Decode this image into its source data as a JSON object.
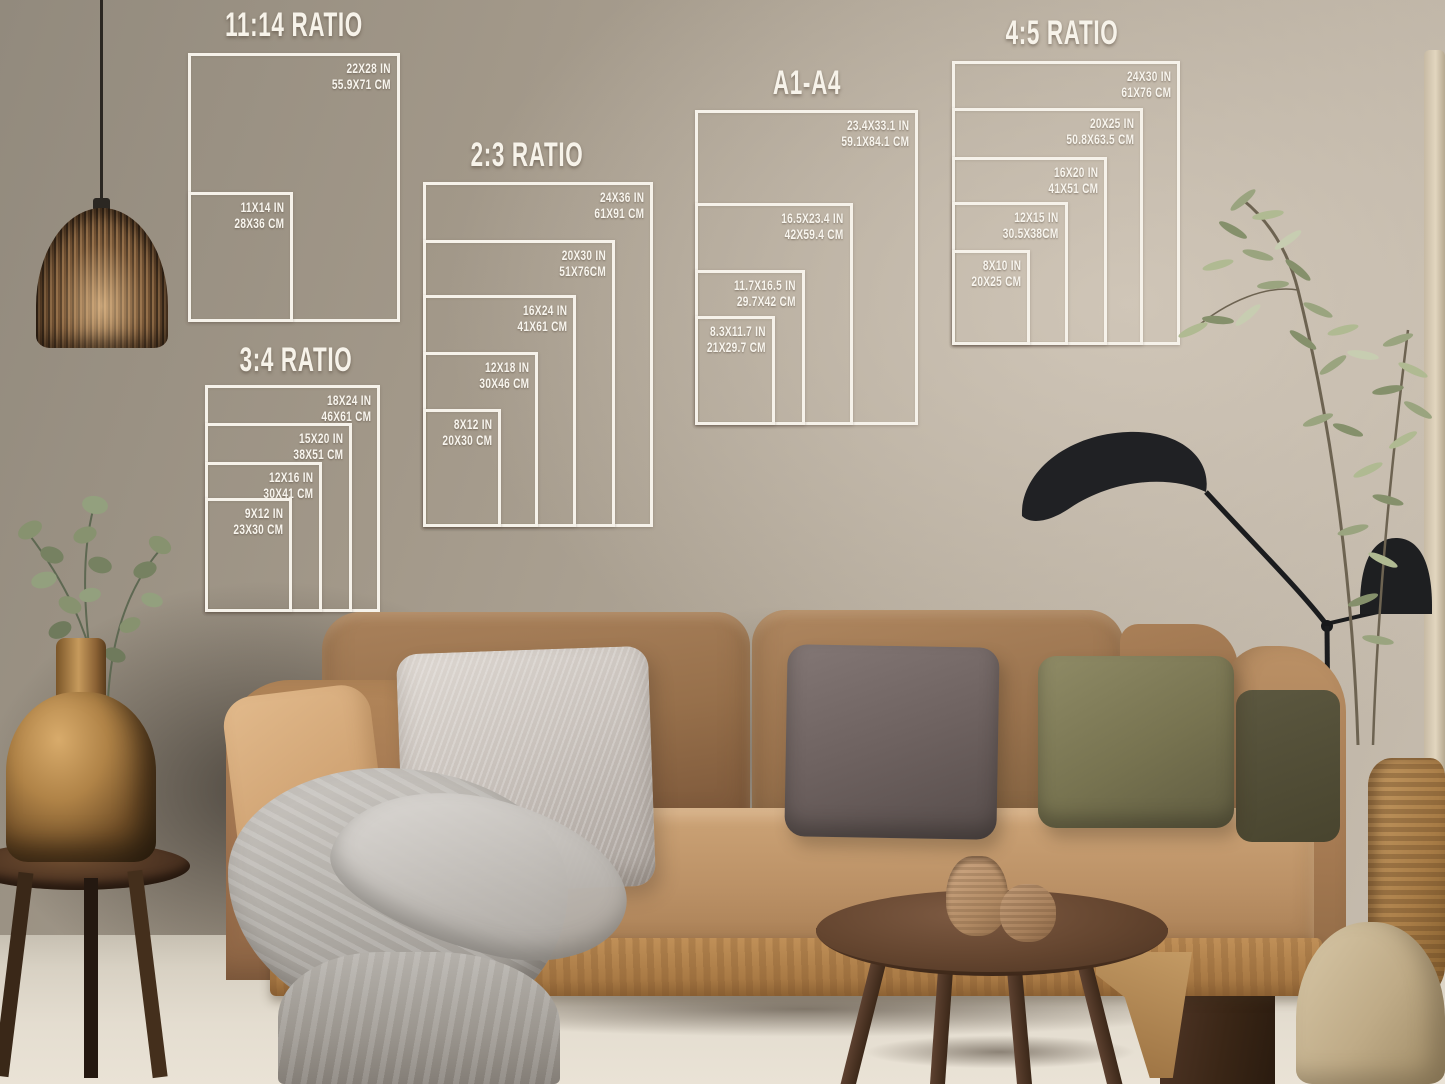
{
  "page": {
    "type": "print-size-guide-mockup",
    "setting": "living-room wall above a tan sofa"
  },
  "palette": {
    "overlay_white": "#f6f2ea",
    "wall": "#aca090",
    "sofa_tan": "#a87c52",
    "floor": "#ddd6c8",
    "lamp_black": "#1e1f21",
    "vase_bronze": "#a97c42",
    "pillow_silver": "#c9c2bc",
    "pillow_dark_gray": "#6e6260",
    "pillow_olive": "#777350"
  },
  "size_guides": [
    {
      "title": "11:14 RATIO",
      "title_cx": 294,
      "title_top": 6,
      "frames": [
        {
          "size_in": "22X28 IN",
          "size_cm": "55.9X71 CM",
          "rect": [
            188,
            53,
            212,
            269
          ]
        },
        {
          "size_in": "11X14 IN",
          "size_cm": "28X36 CM",
          "rect": [
            188,
            192,
            105,
            130
          ]
        }
      ]
    },
    {
      "title": "2:3 RATIO",
      "title_cx": 527,
      "title_top": 136,
      "frames": [
        {
          "size_in": "24X36 IN",
          "size_cm": "61X91 CM",
          "rect": [
            423,
            182,
            230,
            345
          ]
        },
        {
          "size_in": "20X30 IN",
          "size_cm": "51X76CM",
          "rect": [
            423,
            240,
            192,
            287
          ]
        },
        {
          "size_in": "16X24 IN",
          "size_cm": "41X61 CM",
          "rect": [
            423,
            295,
            153,
            232
          ]
        },
        {
          "size_in": "12X18 IN",
          "size_cm": "30X46 CM",
          "rect": [
            423,
            352,
            115,
            175
          ]
        },
        {
          "size_in": "8X12 IN",
          "size_cm": "20X30 CM",
          "rect": [
            423,
            409,
            78,
            118
          ]
        }
      ]
    },
    {
      "title": "3:4 RATIO",
      "title_cx": 296,
      "title_top": 341,
      "frames": [
        {
          "size_in": "18X24 IN",
          "size_cm": "46X61 CM",
          "rect": [
            205,
            385,
            175,
            227
          ]
        },
        {
          "size_in": "15X20 IN",
          "size_cm": "38X51 CM",
          "rect": [
            205,
            423,
            147,
            189
          ]
        },
        {
          "size_in": "12X16 IN",
          "size_cm": "30X41 CM",
          "rect": [
            205,
            462,
            117,
            150
          ]
        },
        {
          "size_in": "9X12 IN",
          "size_cm": "23X30 CM",
          "rect": [
            205,
            498,
            87,
            114
          ]
        }
      ]
    },
    {
      "title": "A1-A4",
      "title_cx": 807,
      "title_top": 64,
      "frames": [
        {
          "size_in": "23.4X33.1 IN",
          "size_cm": "59.1X84.1 CM",
          "rect": [
            695,
            110,
            223,
            315
          ]
        },
        {
          "size_in": "16.5X23.4 IN",
          "size_cm": "42X59.4 CM",
          "rect": [
            695,
            203,
            158,
            222
          ]
        },
        {
          "size_in": "11.7X16.5 IN",
          "size_cm": "29.7X42 CM",
          "rect": [
            695,
            270,
            110,
            155
          ]
        },
        {
          "size_in": "8.3X11.7 IN",
          "size_cm": "21X29.7 CM",
          "rect": [
            695,
            316,
            80,
            109
          ]
        }
      ]
    },
    {
      "title": "4:5 RATIO",
      "title_cx": 1062,
      "title_top": 14,
      "frames": [
        {
          "size_in": "24X30 IN",
          "size_cm": "61X76 CM",
          "rect": [
            952,
            61,
            228,
            284
          ]
        },
        {
          "size_in": "20X25 IN",
          "size_cm": "50.8X63.5 CM",
          "rect": [
            952,
            108,
            191,
            237
          ]
        },
        {
          "size_in": "16X20 IN",
          "size_cm": "41X51 CM",
          "rect": [
            952,
            157,
            155,
            188
          ]
        },
        {
          "size_in": "12X15 IN",
          "size_cm": "30.5X38CM",
          "rect": [
            952,
            202,
            116,
            143
          ]
        },
        {
          "size_in": "8X10 IN",
          "size_cm": "20X25 CM",
          "rect": [
            952,
            250,
            78,
            95
          ]
        }
      ]
    }
  ]
}
